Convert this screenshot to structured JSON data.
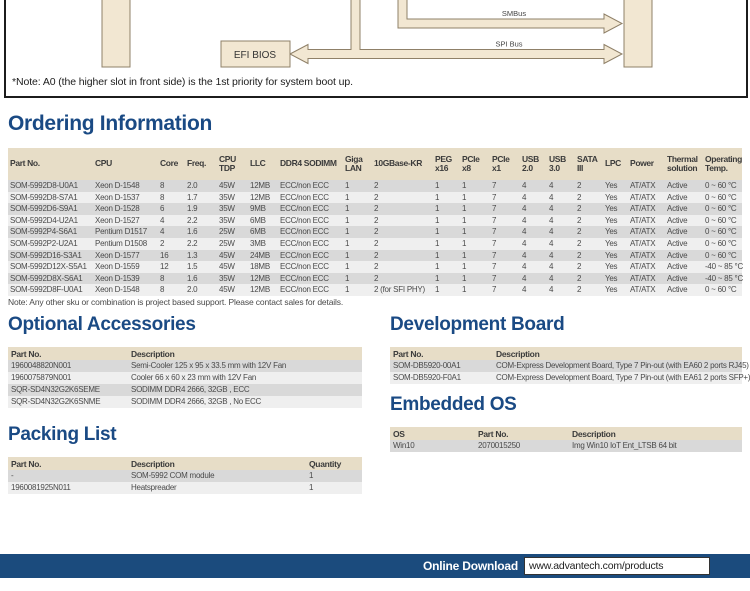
{
  "colors": {
    "accent_blue": "#1a4a84",
    "footer_bar_blue": "#1b4b7d",
    "table_header_beige": "#e7ddc7",
    "row_gray": "#d9d9d9",
    "row_light": "#efefef",
    "diagram_tan": "#f2e7d2",
    "diagram_border": "#8f8068"
  },
  "diagram": {
    "efi_bios_label": "EFI BIOS",
    "smbus_label": "SMBus",
    "spi_label": "SPI Bus",
    "note": "*Note: A0 (the higher slot in front side) is the 1st priority for system boot up."
  },
  "ordering": {
    "title": "Ordering Information",
    "headers": [
      "Part No.",
      "CPU",
      "Core",
      "Freq.",
      "CPU TDP",
      "LLC",
      "DDR4 SODIMM",
      "Giga LAN",
      "10GBase-KR",
      "PEG x16",
      "PCIe x8",
      "PCIe x1",
      "USB 2.0",
      "USB 3.0",
      "SATA III",
      "LPC",
      "Power",
      "Thermal solution",
      "Operating Temp."
    ],
    "rows": [
      [
        "SOM-5992D8-U0A1",
        "Xeon D-1548",
        "8",
        "2.0",
        "45W",
        "12MB",
        "ECC/non ECC",
        "1",
        "2",
        "1",
        "1",
        "7",
        "4",
        "4",
        "2",
        "Yes",
        "AT/ATX",
        "Active",
        "0 ~ 60 °C"
      ],
      [
        "SOM-5992D8-S7A1",
        "Xeon D-1537",
        "8",
        "1.7",
        "35W",
        "12MB",
        "ECC/non ECC",
        "1",
        "2",
        "1",
        "1",
        "7",
        "4",
        "4",
        "2",
        "Yes",
        "AT/ATX",
        "Active",
        "0 ~ 60 °C"
      ],
      [
        "SOM-5992D6-S9A1",
        "Xeon D-1528",
        "6",
        "1.9",
        "35W",
        "9MB",
        "ECC/non ECC",
        "1",
        "2",
        "1",
        "1",
        "7",
        "4",
        "4",
        "2",
        "Yes",
        "AT/ATX",
        "Active",
        "0 ~ 60 °C"
      ],
      [
        "SOM-5992D4-U2A1",
        "Xeon D-1527",
        "4",
        "2.2",
        "35W",
        "6MB",
        "ECC/non ECC",
        "1",
        "2",
        "1",
        "1",
        "7",
        "4",
        "4",
        "2",
        "Yes",
        "AT/ATX",
        "Active",
        "0 ~ 60 °C"
      ],
      [
        "SOM-5992P4-S6A1",
        "Pentium D1517",
        "4",
        "1.6",
        "25W",
        "6MB",
        "ECC/non ECC",
        "1",
        "2",
        "1",
        "1",
        "7",
        "4",
        "4",
        "2",
        "Yes",
        "AT/ATX",
        "Active",
        "0 ~ 60 °C"
      ],
      [
        "SOM-5992P2-U2A1",
        "Pentium D1508",
        "2",
        "2.2",
        "25W",
        "3MB",
        "ECC/non ECC",
        "1",
        "2",
        "1",
        "1",
        "7",
        "4",
        "4",
        "2",
        "Yes",
        "AT/ATX",
        "Active",
        "0 ~ 60 °C"
      ],
      [
        "SOM-5992D16-S3A1",
        "Xeon D-1577",
        "16",
        "1.3",
        "45W",
        "24MB",
        "ECC/non ECC",
        "1",
        "2",
        "1",
        "1",
        "7",
        "4",
        "4",
        "2",
        "Yes",
        "AT/ATX",
        "Active",
        "0 ~ 60 °C"
      ],
      [
        "SOM-5992D12X-S5A1",
        "Xeon D-1559",
        "12",
        "1.5",
        "45W",
        "18MB",
        "ECC/non ECC",
        "1",
        "2",
        "1",
        "1",
        "7",
        "4",
        "4",
        "2",
        "Yes",
        "AT/ATX",
        "Active",
        "-40 ~ 85 °C"
      ],
      [
        "SOM-5992D8X-S6A1",
        "Xeon D-1539",
        "8",
        "1.6",
        "35W",
        "12MB",
        "ECC/non ECC",
        "1",
        "2",
        "1",
        "1",
        "7",
        "4",
        "4",
        "2",
        "Yes",
        "AT/ATX",
        "Active",
        "-40 ~ 85 °C"
      ],
      [
        "SOM-5992D8F-U0A1",
        "Xeon D-1548",
        "8",
        "2.0",
        "45W",
        "12MB",
        "ECC/non ECC",
        "1",
        "2 (for SFI PHY)",
        "1",
        "1",
        "7",
        "4",
        "4",
        "2",
        "Yes",
        "AT/ATX",
        "Active",
        "0 ~ 60 °C"
      ]
    ],
    "note": "Note: Any other sku or combination is project based support. Please contact sales for details."
  },
  "optional_accessories": {
    "title": "Optional Accessories",
    "headers": [
      "Part No.",
      "Description"
    ],
    "rows": [
      [
        "1960048820N001",
        "Semi-Cooler 125 x 95 x 33.5 mm with 12V Fan"
      ],
      [
        "1960075879N001",
        "Cooler 66 x 60 x 23 mm with 12V Fan"
      ],
      [
        "SQR-SD4N32G2K6SEME",
        "SODIMM DDR4 2666, 32GB , ECC"
      ],
      [
        "SQR-SD4N32G2K6SNME",
        "SODIMM DDR4 2666, 32GB , No ECC"
      ]
    ]
  },
  "packing_list": {
    "title": "Packing List",
    "headers": [
      "Part No.",
      "Description",
      "Quantity"
    ],
    "rows": [
      [
        "-",
        "SOM-5992 COM module",
        "1"
      ],
      [
        "1960081925N011",
        "Heatspreader",
        "1"
      ]
    ]
  },
  "development_board": {
    "title": "Development Board",
    "headers": [
      "Part No.",
      "Description"
    ],
    "rows": [
      [
        "SOM-DB5920-00A1",
        "COM-Express Development Board, Type 7 Pin-out (with EA60 2 ports RJ45)"
      ],
      [
        "SOM-DB5920-F0A1",
        "COM-Express Development Board, Type 7 Pin-out (with EA61 2 ports SFP+)"
      ]
    ]
  },
  "embedded_os": {
    "title": "Embedded OS",
    "headers": [
      "OS",
      "Part No.",
      "Description"
    ],
    "rows": [
      [
        "Win10",
        "2070015250",
        "Img Win10 IoT Ent_LTSB 64 bit"
      ]
    ]
  },
  "footer": {
    "label": "Online Download",
    "url": "www.advantech.com/products"
  }
}
